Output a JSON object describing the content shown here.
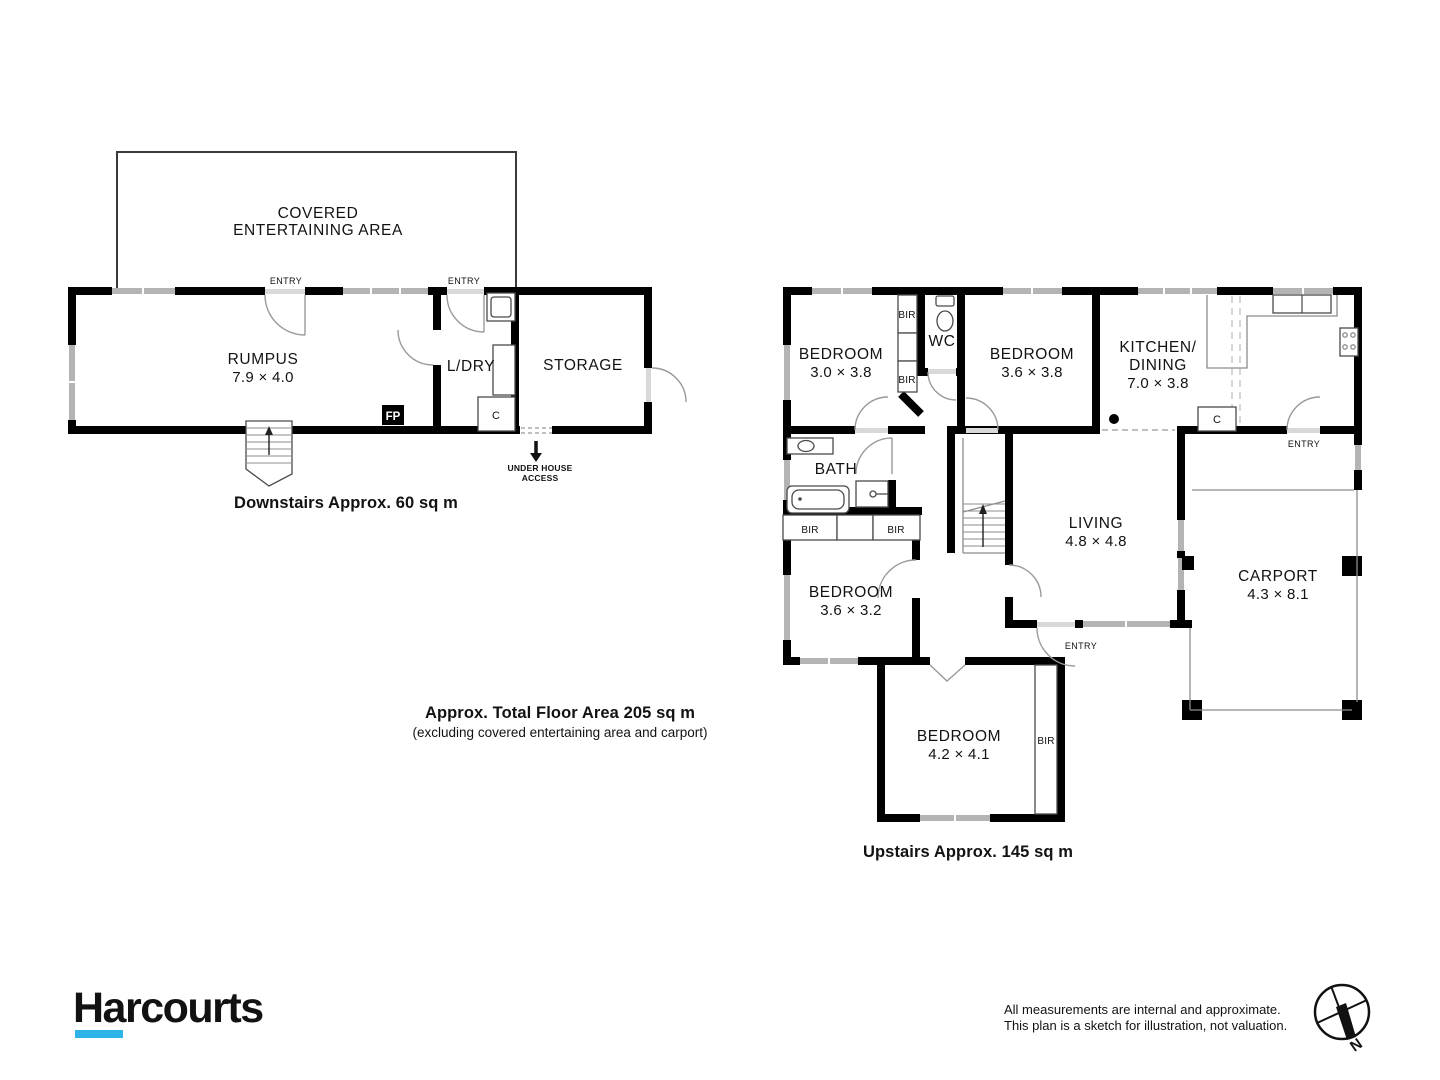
{
  "colors": {
    "wall": "#000000",
    "window_gray": "#b4b4b4",
    "brand_navy": "#17265c",
    "brand_blue": "#2db3e8"
  },
  "downstairs": {
    "covered_area": {
      "line1": "COVERED",
      "line2": "ENTERTAINING AREA"
    },
    "rumpus": {
      "name": "RUMPUS",
      "dims": "7.9 × 4.0"
    },
    "laundry": {
      "name": "L/DRY"
    },
    "storage": {
      "name": "STORAGE"
    },
    "entry_label": "ENTRY",
    "fireplace_label": "FP",
    "closet_label": "C",
    "under_house": {
      "line1": "UNDER HOUSE",
      "line2": "ACCESS"
    },
    "caption": "Downstairs Approx. 60 sq m"
  },
  "upstairs": {
    "bedroom1": {
      "name": "BEDROOM",
      "dims": "3.0 × 3.8"
    },
    "wc": {
      "name": "WC"
    },
    "bedroom2": {
      "name": "BEDROOM",
      "dims": "3.6 × 3.8"
    },
    "kitchen": {
      "line1": "KITCHEN/",
      "line2": "DINING",
      "dims": "7.0 × 3.8"
    },
    "bath": {
      "name": "BATH"
    },
    "bedroom3": {
      "name": "BEDROOM",
      "dims": "3.6 × 3.2"
    },
    "living": {
      "name": "LIVING",
      "dims": "4.8 × 4.8"
    },
    "carport": {
      "name": "CARPORT",
      "dims": "4.3 × 8.1"
    },
    "bedroom4": {
      "name": "BEDROOM",
      "dims": "4.2 × 4.1"
    },
    "bir_label": "BIR",
    "closet_label": "C",
    "entry_label": "ENTRY",
    "caption": "Upstairs Approx. 145 sq m"
  },
  "summary": {
    "total": "Approx. Total Floor Area 205 sq m",
    "note": "(excluding covered entertaining area and carport)"
  },
  "footer": {
    "brand": "Harcourts",
    "disclaimer1": "All measurements are internal and approximate.",
    "disclaimer2": "This plan is a sketch for illustration, not valuation.",
    "compass_north": "N"
  }
}
